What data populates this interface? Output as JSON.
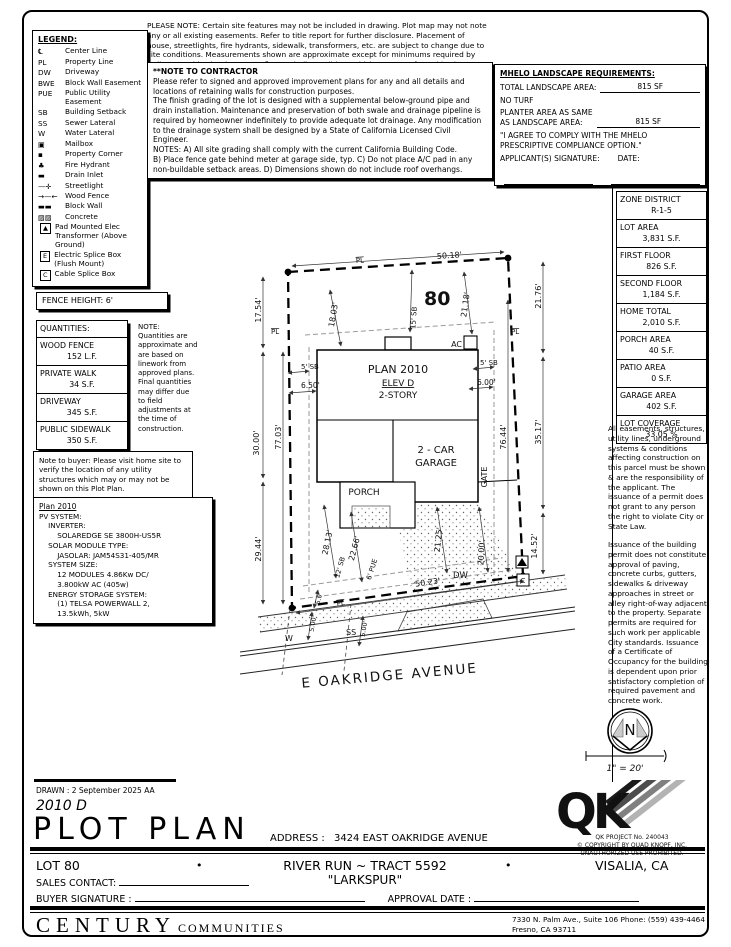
{
  "top_note": "PLEASE NOTE:  Certain site features may not be included in drawing.  Plot map may not note any or all existing easements. Refer to title report for further disclosure.  Placement of house, streetlights, fire hydrants, sidewalk, transformers, etc. are subject to change due to site conditions.  Measurements shown are approximate except for minimums required by ordinance.  This plot does not reflect as-built conditions which may vary from this plan.",
  "legend": {
    "title": "LEGEND:",
    "items": [
      {
        "sym": "℄",
        "label": "Center Line"
      },
      {
        "sym": "PL",
        "label": "Property Line"
      },
      {
        "sym": "DW",
        "label": "Driveway"
      },
      {
        "sym": "BWE",
        "label": "Block Wall Easement"
      },
      {
        "sym": "PUE",
        "label": "Public Utility Easement"
      },
      {
        "sym": "SB",
        "label": "Building Setback"
      },
      {
        "sym": "SS",
        "label": "Sewer Lateral"
      },
      {
        "sym": "W",
        "label": "Water Lateral"
      },
      {
        "sym": "▣",
        "label": "Mailbox"
      },
      {
        "sym": "▪",
        "label": "Property Corner"
      },
      {
        "sym": "♣",
        "label": "Fire Hydrant"
      },
      {
        "sym": "▬",
        "label": "Drain Inlet"
      },
      {
        "sym": "—✛",
        "label": "Streetlight"
      },
      {
        "sym": "→—←",
        "label": "Wood Fence"
      },
      {
        "sym": "▬▬",
        "label": "Block Wall"
      },
      {
        "sym": "▨▨",
        "label": "Concrete"
      },
      {
        "sym": "▲",
        "label": "Pad Mounted Elec Transformer (Above Ground)",
        "boxed": true
      },
      {
        "sym": "E",
        "label": "Electric Splice Box (Flush Mount)",
        "boxed": true
      },
      {
        "sym": "C",
        "label": "Cable Splice Box",
        "boxed": true
      }
    ]
  },
  "contractor_note": {
    "title": "**NOTE TO CONTRACTOR",
    "body": "Please refer to signed and approved improvement plans for any and all details and locations of retaining walls for construction purposes.\nThe finish grading of the lot is designed with a supplemental below-ground pipe and drain installation.  Maintenance and preservation of both swale and drainage pipeline is required by homeowner indefinitely to provide adequate lot drainage.  Any modification to the drainage system shall be designed by a State of California Licensed Civil Engineer.\nNOTES:  A) All site grading shall comply with the current California Building Code.\nB) Place fence gate behind meter at garage side, typ.  C) Do not place A/C pad in any non-buildable setback areas.  D) Dimensions shown do not include roof overhangs."
  },
  "mhelo": {
    "title": "MHELO LANDSCAPE REQUIREMENTS:",
    "total_label": "TOTAL LANDSCAPE AREA:",
    "total_value": "815 SF",
    "no_turf": "NO TURF",
    "planter_label": "PLANTER AREA AS SAME\nAS LANDSCAPE AREA:",
    "planter_value": "815 SF",
    "agree": "\"I AGREE TO COMPLY WITH THE MHELO PRESCRIPTIVE COMPLIANCE OPTION.\"",
    "signature_label": "APPLICANT(S) SIGNATURE:",
    "date_label": "DATE:"
  },
  "zone_table": {
    "rows": [
      {
        "label": "ZONE DISTRICT",
        "value": "R-1-5"
      },
      {
        "label": "LOT AREA",
        "value": "3,831 S.F."
      },
      {
        "label": "FIRST FLOOR",
        "value": "826 S.F."
      },
      {
        "label": "SECOND FLOOR",
        "value": "1,184 S.F."
      },
      {
        "label": "HOME TOTAL",
        "value": "2,010 S.F."
      },
      {
        "label": "PORCH AREA",
        "value": "40 S.F."
      },
      {
        "label": "PATIO AREA",
        "value": "0 S.F."
      },
      {
        "label": "GARAGE AREA",
        "value": "402 S.F."
      },
      {
        "label": "LOT COVERAGE",
        "value": "33.05 %"
      }
    ]
  },
  "right_notes": {
    "para1": "All easements, structures, utility lines, underground systems & conditions affecting construction on this parcel must be shown & are the responsibility of the applicant. The issuance of a permit does not grant to any person the right to violate City or State Law.",
    "para2": "Issuance of the building permit does not constitute approval of paving, concrete curbs, gutters, sidewalks & driveway approaches in street or alley right-of-way adjacent to the property. Separate permits are required for such work per applicable City standards. Issuance of a Certificate of Occupancy for the building is dependent upon prior satisfactory completion of required pavement and concrete work."
  },
  "fence_height": "FENCE HEIGHT: 6'",
  "quantities": {
    "title": "QUANTITIES:",
    "rows": [
      {
        "label": "WOOD FENCE",
        "value": "152 L.F."
      },
      {
        "label": "PRIVATE WALK",
        "value": "34 S.F."
      },
      {
        "label": "DRIVEWAY",
        "value": "345 S.F."
      },
      {
        "label": "PUBLIC SIDEWALK",
        "value": "350 S.F."
      }
    ]
  },
  "quantities_note": "NOTE:\nQuantities are approximate and are based on linework from approved plans.  Final quantities may differ due to field adjustments at the time of construction.",
  "buyer_note": "Note to buyer: Please visit home site to verify the location of any utility structures which may or may not be shown on this Plot Plan.",
  "pv": {
    "title": "Plan 2010",
    "lines": [
      "PV SYSTEM:",
      "    INVERTER:",
      "        SOLAREDGE SE 3800H-US5R",
      "    SOLAR MODULE TYPE:",
      "        JASOLAR: JAM54S31-405/MR",
      "    SYSTEM SIZE:",
      "        12 MODULES 4.86Kw DC/",
      "        3.800kW AC (405w)",
      "    ENERGY STORAGE SYSTEM:",
      "        (1) TELSA POWERWALL 2,",
      "        13.5kWh, 5kW"
    ]
  },
  "drawing": {
    "lot_number": "80",
    "dim_top": "50.18'",
    "dim_bottom": "50.23'",
    "dim_left_upper": "17.54'",
    "dim_left_mid": "30.00'",
    "dim_left_lower": "29.44'",
    "dim_left_inner": "77.03'",
    "dim_right_upper": "21.76'",
    "dim_right_mid": "35.17'",
    "dim_right_lower": "14.52'",
    "dim_right_inner": "76.44'",
    "dim_diag_left": "18.03'",
    "dim_diag_right": "21.18'",
    "sb15": "15' SB",
    "sb5_left": "5' SB",
    "dim_650": "6.50'",
    "sb5_right": "5' SB",
    "dim_600": "6.00'",
    "plan_title": "PLAN 2010",
    "plan_elev": "ELEV D",
    "plan_story": "2-STORY",
    "ac": "AC",
    "garage_line1": "2 - CAR",
    "garage_line2": "GARAGE",
    "porch": "PORCH",
    "dim_2813": "28.13'",
    "dim_2266": "22.66'",
    "sb12": "12' SB",
    "pue6": "6' PUE",
    "dim_2125": "21.25'",
    "dim_2000": "20.00'",
    "gate": "GATE",
    "dim_50": "5.0'",
    "dim_500a": "5.00'",
    "dim_500b": "5.00'",
    "w_mark": "W",
    "ss_mark": "SS",
    "dw": "DW",
    "street": "E OAKRIDGE AVENUE",
    "pl_top": "PL",
    "pl_left": "PL",
    "pl_right": "PL",
    "pl_bottom": "PL",
    "cable_box": "C"
  },
  "compass": {
    "north": "N",
    "scale": "1\" = 20'"
  },
  "qk": {
    "logo": "QK",
    "line1": "QK PROJECT No. 240043",
    "line2": "©  COPYRIGHT BY QUAD KNOPF, INC.",
    "line3": "UNAUTHORIZED USE PROHIBITED."
  },
  "titleblock": {
    "drawn": "DRAWN :  2 September 2025   AA",
    "plan_code": "2010 D",
    "title": "PLOT PLAN",
    "address_label": "ADDRESS :",
    "address": "3424 EAST OAKRIDGE AVENUE",
    "lot": "LOT 80",
    "bullet1": "•",
    "tract": "RIVER RUN ~ TRACT 5592",
    "tract2": "\"LARKSPUR\"",
    "bullet2": "•",
    "city": "VISALIA, CA",
    "sales_label": "SALES CONTACT:",
    "buyer_label": "BUYER SIGNATURE :",
    "approval_label": "APPROVAL DATE :"
  },
  "footer": {
    "brand1": "CENTURY",
    "brand2": "COMMUNITIES",
    "addr1": "7330 N. Palm Ave., Suite 106    Phone:  (559) 439-4464",
    "addr2": "Fresno, CA  93711"
  }
}
